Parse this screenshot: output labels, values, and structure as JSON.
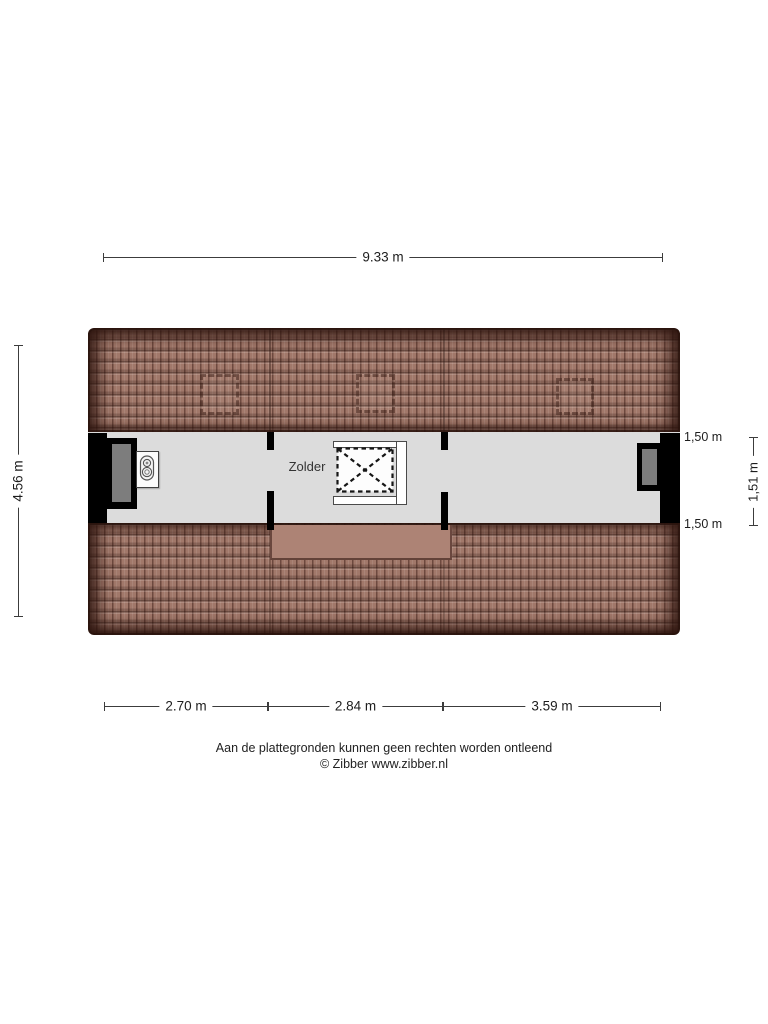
{
  "floorplan": {
    "room_label": "Zolder",
    "dimensions": {
      "top": "9.33 m",
      "left": "4.56 m",
      "right_top": "1,50 m",
      "right_middle": "1,51 m",
      "right_bottom": "1,50 m",
      "bottom": [
        "2.70 m",
        "2.84 m",
        "3.59 m"
      ]
    },
    "icons": {
      "stairwell": "dashed-box-with-x-cross",
      "boiler": "rounded-unit-with-two-dials",
      "roof_window": "dashed-square-outline"
    },
    "colors": {
      "roof_tile": "#a1786a",
      "roof_edge": "#3a1f16",
      "floor": "#dcdcdc",
      "wall": "#000000",
      "window": "#7d7d7d",
      "dim_line": "#3c3c3c",
      "text": "#1d1d1d"
    }
  },
  "footer": {
    "disclaimer": "Aan de plattegronden kunnen geen rechten worden ontleend",
    "copyright": "© Zibber www.zibber.nl"
  }
}
